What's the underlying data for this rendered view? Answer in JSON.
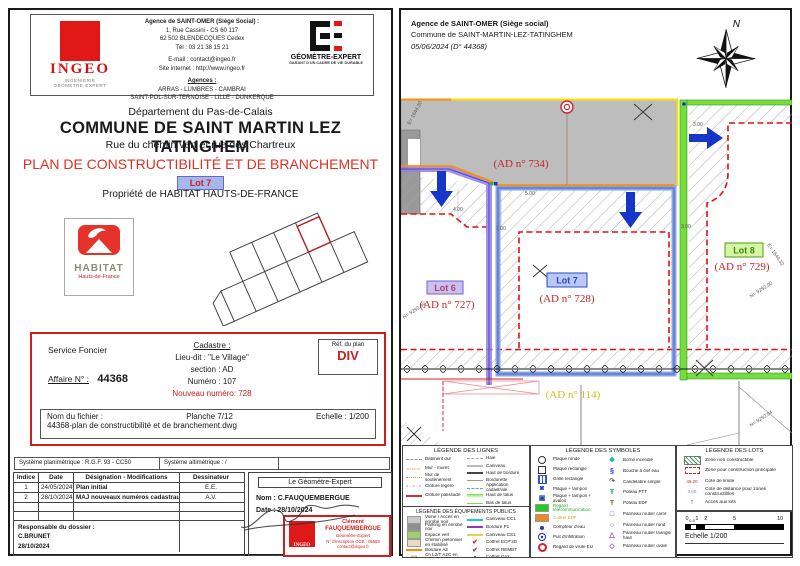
{
  "left_page": {
    "ingeo_logo": {
      "name": "INGEO",
      "sub1": "INGENIERIE",
      "sub2": "GEOMETRE-EXPERT"
    },
    "agency": {
      "line1": "Agence de SAINT-OMER (Siège Social) :",
      "line2": "1, Rue Cassini - CS 60 117",
      "line3": "62 502 BLENDECQUES Cedex",
      "line4": "Tél : 03 21 38 15 21",
      "line5": "E-mail : contact@ingeo.fr",
      "line6": "Site internet : http://www.ingeo.fr",
      "line7": "Agences :",
      "line8": "ARRAS - LUMBRES - CAMBRAI",
      "line9": "SAINT-POL-SUR-TERNOISE - LILLE - DUNKERQUE"
    },
    "ge_logo": {
      "name": "GÉOMÈTRE-EXPERT",
      "tagline": "GARANT D'UN CADRE DE VIE DURABLE"
    },
    "titles": {
      "dept": "Département du Pas-de-Calais",
      "commune": "COMMUNE DE SAINT MARTIN LEZ TATINGHEM",
      "street": "Rue du chemin vert et rue des Chartreux",
      "plan_title": "PLAN DE CONSTRUCTIBILITÉ ET DE BRANCHEMENT",
      "lot_badge": "Lot 7",
      "owner": "Propriété de HABITAT HAUTS-DE-FRANCE"
    },
    "habitat": {
      "name": "HABITAT",
      "sub": "Hauts-de-France"
    },
    "infobox": {
      "service": "Service Foncier",
      "affaire_label": "Affaire N° :",
      "affaire_value": "44368",
      "cadastre_title": "Cadastre :",
      "lieu_dit": "Lieu-dit : \"Le Village\"",
      "section": "section : AD",
      "numero": "Numéro : 107",
      "nouveau": "Nouveau numéro: 728",
      "ref_label": "Réf. du plan",
      "ref_value": "DIV",
      "fichier_label": "Nom du fichier :",
      "planche": "Planche 7/12",
      "echelle": "Echelle : 1/200",
      "fichier_value": "44368-plan de constructibilité et de branchement.dwg"
    },
    "systems": {
      "planimetrique": "Système planimétrique : R.G.F. 93 - CC50",
      "altimetrique": "Système altimétrique : /"
    },
    "revisions": {
      "headers": [
        "Indice",
        "Date",
        "Désignation - Modifications",
        "Dessinateur"
      ],
      "rows": [
        [
          "1",
          "24/05/2024",
          "Plan initial",
          "E.E."
        ],
        [
          "2",
          "28/10/2024",
          "MAJ nouveaux numéros cadastraux",
          "A.V."
        ]
      ],
      "responsable_label": "Responsable du dossier :",
      "responsable_name": "C.BRUNET",
      "responsable_date": "28/10/2024"
    },
    "geometre": {
      "title": "Le Géomètre-Expert",
      "nom": "Nom : C.FAUQUEMBERGUE",
      "date": "Date : 28/10/2024",
      "stamp_logo": "INGEO",
      "stamp1": "Clément",
      "stamp2": "FAUQUEMBERGUE",
      "stamp3": "Géomètre-Expert",
      "stamp4": "N° d'inscription OGE : 05569",
      "stamp5": "contact@ingeo.fr"
    }
  },
  "right_page": {
    "header": {
      "line1": "Agence de SAINT-OMER (Siège social)",
      "line2": "Commune de SAINT-MARTIN-LEZ-TATINGHEM",
      "line3": "05/06/2024 (D° 44368)",
      "compass": "N"
    },
    "plan": {
      "road_label": "(AD n° 734)",
      "lot6_badge": "Lot 6",
      "lot6_parcel": "(AD n° 727)",
      "lot7_badge": "Lot 7",
      "lot7_parcel": "(AD n° 728)",
      "lot8_badge": "Lot 8",
      "lot8_parcel": "(AD n° 729)",
      "bottom_parcel": "(AD n° 114)",
      "dims": [
        "4.00",
        "3.00",
        "3.00",
        "3.00",
        "5.00"
      ],
      "coords": [
        "E= 1644.30",
        "N= 9292.99",
        "N= 9292.90",
        "E= 1644.32",
        "N= 9292.94"
      ],
      "accent_colors": {
        "access_arrow": "#1536c8",
        "lot6_boundary": "#9080e0",
        "lot7_boundary": "#7d9ae0",
        "lot8_boundary": "#76dd3e",
        "construction_zone": "#e01010"
      }
    }
  },
  "legend_lines": {
    "title": "LÉGENDE DES LIGNES",
    "col1": [
      {
        "label": "Bâtiment dur",
        "swatch": "dash",
        "color": "#999999"
      },
      {
        "label": "Mur - muret",
        "swatch": "boxes",
        "glyph": "▭▭▭",
        "color": "#e08030"
      },
      {
        "label": "Mur de soutènement",
        "swatch": "dashdot",
        "color": "#999999"
      },
      {
        "label": "Clôture légère",
        "swatch": "xline",
        "glyph": "×-×-×",
        "color": "#999999"
      },
      {
        "label": "Clôture palissade",
        "swatch": "line",
        "color": "#cc3333"
      }
    ],
    "col2": [
      {
        "label": "Haie",
        "swatch": "dash",
        "color": "#aaaaaa"
      },
      {
        "label": "Caniveau",
        "swatch": "line",
        "color": "#bbbbbb"
      },
      {
        "label": "Haut de bordure",
        "swatch": "line",
        "color": "#444444"
      },
      {
        "label": "Bordurette",
        "swatch": "thin",
        "color": "#999999"
      },
      {
        "label": "Application cadastrale",
        "swatch": "dash",
        "color": "#33bbbb"
      },
      {
        "label": "Haut de talus",
        "swatch": "talus",
        "color": "#7ae04a"
      },
      {
        "label": "Bas de talus",
        "swatch": "thin",
        "color": "#7ae04a"
      }
    ]
  },
  "legend_equip": {
    "title": "LÉGENDE DES ÉQUIPEMENTS PUBLICS",
    "col1": [
      {
        "label": "Voirie / Accès en enrobé noir",
        "swatch": "box",
        "color": "#c9c9c9"
      },
      {
        "label": "Parking en enrobé noir",
        "swatch": "box",
        "color": "#8f8f8f"
      },
      {
        "label": "Espace vert",
        "swatch": "box",
        "color": "#9ed06a"
      },
      {
        "label": "Chemin piétonnier en stabilisé",
        "swatch": "box",
        "color": "#e6dcc0"
      },
      {
        "label": "Bordure A2",
        "swatch": "line",
        "color": "#ff8c00"
      },
      {
        "label": "Ch L2/T A2C en voirie",
        "swatch": "glyph",
        "glyph": "▭",
        "color": "#888888"
      }
    ],
    "col2": [
      {
        "label": "Caniveau CC1",
        "swatch": "line",
        "color": "#22c8c8"
      },
      {
        "label": "Bordure P1",
        "swatch": "line",
        "color": "#9933bb"
      },
      {
        "label": "Caniveau CS1",
        "swatch": "line",
        "color": "#e8d44a"
      },
      {
        "label": "Coffret ECP'2D",
        "swatch": "glyph",
        "glyph": "✔",
        "color": "#cc2222"
      },
      {
        "label": "Coffret REMBT",
        "swatch": "glyph",
        "glyph": "✔",
        "color": "#cc2222"
      },
      {
        "label": "Coffret Gaz",
        "swatch": "glyph",
        "glyph": "▪",
        "color": "#cc2222"
      }
    ]
  },
  "legend_symbols": {
    "title": "LÉGENDE DES SYMBOLES",
    "col1": [
      {
        "label": "Plaque ronde",
        "swatch": "circle",
        "color": "#333333"
      },
      {
        "label": "Plaque rectangle",
        "swatch": "square",
        "color": "#333333"
      },
      {
        "label": "Grille rectangle",
        "swatch": "grid",
        "color": "#3355cc"
      },
      {
        "label": "Plaque + tampon",
        "swatch": "glyph",
        "glyph": "◙",
        "color": "#2244aa"
      },
      {
        "label": "Plaque + tampon + avaloir",
        "swatch": "glyph",
        "glyph": "▣",
        "color": "#2244aa"
      },
      {
        "label": "Regard télécommunication",
        "swatch": "box",
        "color": "#22cc22",
        "lc": "#22aa22"
      },
      {
        "label": "Coffret EDF",
        "swatch": "box",
        "color": "#ee8822",
        "lc": "#bbaa22"
      },
      {
        "label": "Compteur d'eau",
        "swatch": "dot",
        "color": "#2233bb"
      },
      {
        "label": "Puit d'infiltration",
        "swatch": "target",
        "color": "#2233bb"
      },
      {
        "label": "Regard de visite EU",
        "swatch": "donut",
        "color": "#cc2222"
      }
    ],
    "col2": [
      {
        "label": "Borne incendie",
        "swatch": "glyph",
        "glyph": "❖",
        "color": "#18b8a8"
      },
      {
        "label": "Bouche à clef eau",
        "swatch": "glyph",
        "glyph": "§",
        "color": "#2233bb"
      },
      {
        "label": "Candélabre simple",
        "swatch": "glyph",
        "glyph": "↷",
        "color": "#555555"
      },
      {
        "label": "Poteau PTT",
        "swatch": "glyph",
        "glyph": "Ŧ",
        "color": "#22aa55"
      },
      {
        "label": "Poteau EDF",
        "swatch": "glyph",
        "glyph": "Ŧ",
        "color": "#aa6644"
      },
      {
        "label": "Panneau routier carré",
        "swatch": "glyph",
        "glyph": "□",
        "color": "#8844cc"
      },
      {
        "label": "Panneau routier rond",
        "swatch": "glyph",
        "glyph": "○",
        "color": "#8844cc"
      },
      {
        "label": "Panneau routier triangle haut",
        "swatch": "glyph",
        "glyph": "△",
        "color": "#8844cc"
      },
      {
        "label": "Panneau routier ovale",
        "swatch": "glyph",
        "glyph": "◇",
        "color": "#8844cc"
      }
    ]
  },
  "legend_lots": {
    "title": "LÉGENDE DES LOTS",
    "items": [
      {
        "label": "Zone non constructible",
        "swatch": "hatch",
        "color": "#2a9a4a"
      },
      {
        "label": "Zone pour construction principale",
        "swatch": "dashedrect",
        "color": "#cc2222"
      },
      {
        "label": "Cote de limite",
        "swatch": "text",
        "glyph": "45.20",
        "color": "#cc2222"
      },
      {
        "label": "Cote de distance pour zones constructibles",
        "swatch": "text",
        "glyph": "3.00",
        "color": "#888888"
      },
      {
        "label": "Accès aux lots",
        "swatch": "glyph",
        "glyph": "↑",
        "color": "#1536c8"
      }
    ]
  },
  "scale": {
    "numbers": [
      "0",
      "0.5",
      "1",
      "2",
      "5",
      "10"
    ],
    "label": "Echelle 1/200"
  }
}
